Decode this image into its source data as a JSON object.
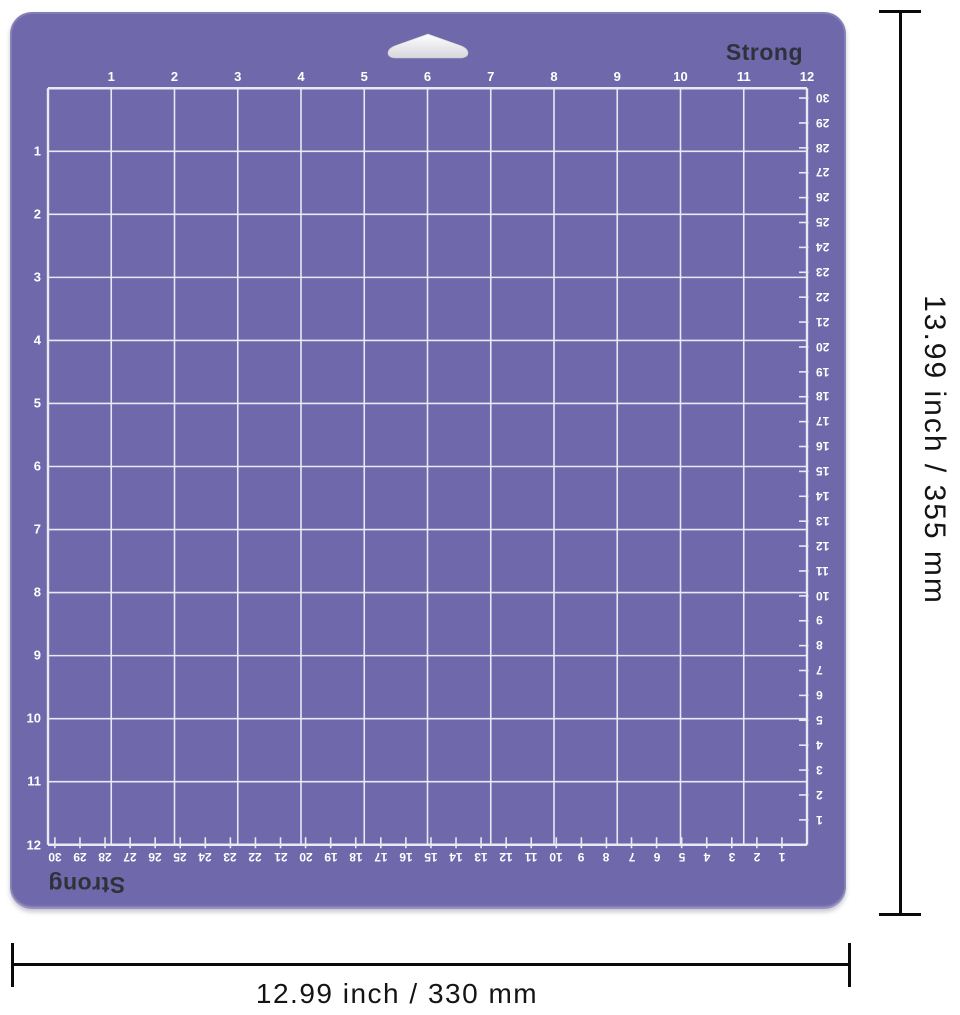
{
  "mat": {
    "brand_label_top": "Strong",
    "brand_label_bottom": "Strong",
    "surface_color": "#6f68aa",
    "grid_line_color": "#eae8f4",
    "number_color": "#ffffff",
    "inch_labels_top": [
      "1",
      "2",
      "3",
      "4",
      "5",
      "6",
      "7",
      "8",
      "9",
      "10",
      "11",
      "12"
    ],
    "inch_labels_left": [
      "1",
      "2",
      "3",
      "4",
      "5",
      "6",
      "7",
      "8",
      "9",
      "10",
      "11",
      "12"
    ],
    "cm_labels_right": [
      30,
      29,
      28,
      27,
      26,
      25,
      24,
      23,
      22,
      21,
      20,
      19,
      18,
      17,
      16,
      15,
      14,
      13,
      12,
      11,
      10,
      9,
      8,
      7,
      6,
      5,
      4,
      3,
      2,
      1
    ],
    "cm_labels_bottom": [
      30,
      29,
      28,
      27,
      26,
      25,
      24,
      23,
      22,
      21,
      20,
      19,
      18,
      17,
      16,
      15,
      14,
      13,
      12,
      11,
      10,
      9,
      8,
      7,
      6,
      5,
      4,
      3,
      2,
      1
    ]
  },
  "dimension_annotations": {
    "height_label": "13.99 inch / 355 mm",
    "width_label": "12.99 inch / 330 mm",
    "line_color": "#0a0a0a"
  }
}
